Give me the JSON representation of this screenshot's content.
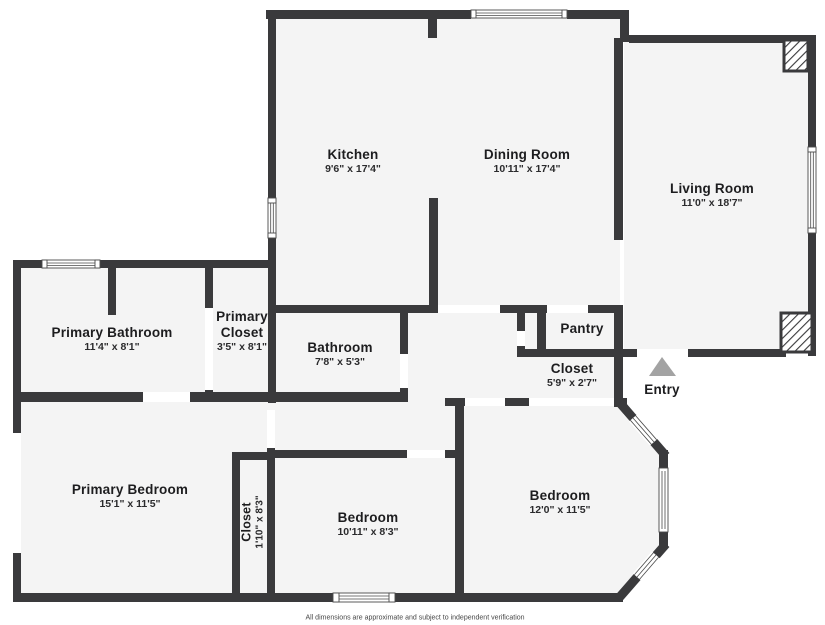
{
  "title": "Floor plan",
  "rooms": {
    "kitchen": {
      "name": "Kitchen",
      "dims": "9'6\" x 17'4\""
    },
    "dining": {
      "name": "Dining Room",
      "dims": "10'11\" x 17'4\""
    },
    "living": {
      "name": "Living Room",
      "dims": "11'0\" x 18'7\""
    },
    "primary_bathroom": {
      "name": "Primary Bathroom",
      "dims": "11'4\" x 8'1\""
    },
    "primary_closet": {
      "name_line1": "Primary",
      "name_line2": "Closet",
      "dims": "3'5\" x 8'1\""
    },
    "bathroom": {
      "name": "Bathroom",
      "dims": "7'8\" x 5'3\""
    },
    "pantry": {
      "name": "Pantry"
    },
    "hall_closet": {
      "name": "Closet",
      "dims": "5'9\" x 2'7\""
    },
    "entry": {
      "name": "Entry"
    },
    "primary_bedroom": {
      "name": "Primary Bedroom",
      "dims": "15'1\" x 11'5\""
    },
    "bedroom_closet": {
      "name": "Closet",
      "dims": "1'10\" x 8'3\""
    },
    "bedroom_middle": {
      "name": "Bedroom",
      "dims": "10'11\" x 8'3\""
    },
    "bedroom_right": {
      "name": "Bedroom",
      "dims": "12'0\" x 11'5\""
    }
  },
  "footer": {
    "disclaimer": "All dimensions are approximate and subject to independent verification"
  },
  "colors": {
    "wall": "#3a3a3c",
    "floor": "#f4f4f4",
    "label": "#1d1d1f",
    "triangle": "#a3a3a3"
  }
}
